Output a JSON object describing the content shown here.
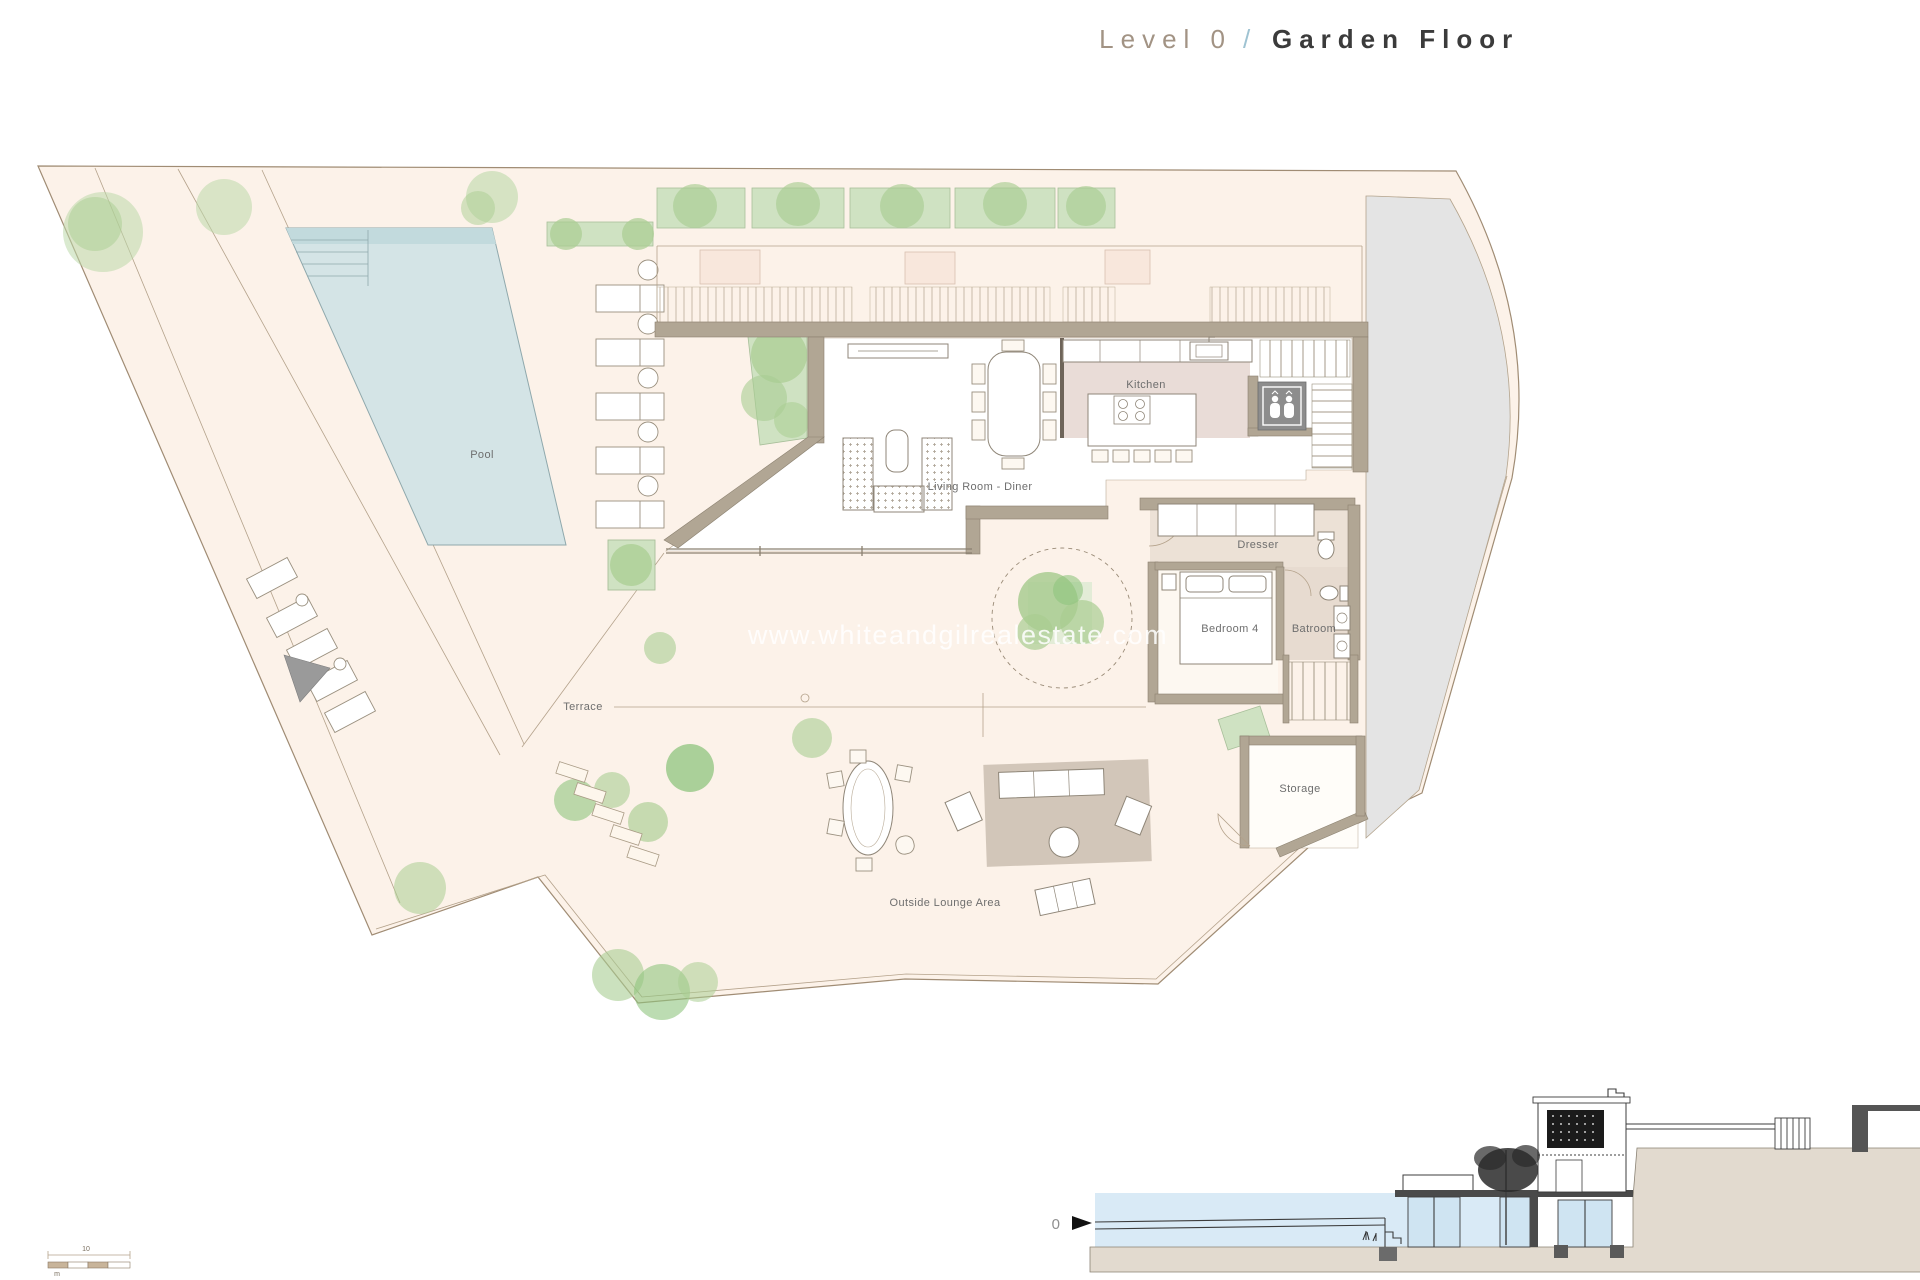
{
  "title": {
    "level": "Level 0",
    "separator": "/",
    "floor": "Garden Floor"
  },
  "watermark": "www.whiteandgilrealestate.com",
  "rooms": {
    "pool": "Pool",
    "terrace": "Terrace",
    "kitchen": "Kitchen",
    "living_room": "Living Room - Diner",
    "dresser": "Dresser",
    "bedroom4": "Bedroom 4",
    "bathroom": "Batroom",
    "storage": "Storage",
    "outside_lounge": "Outside Lounge Area"
  },
  "section": {
    "level_marker": "0"
  },
  "scale_bar": {
    "distance_label": "10",
    "unit_label": "m"
  },
  "colors": {
    "plot_fill": "#fcf2e9",
    "pool_water": "#d4e4e6",
    "wall": "#b1a694",
    "greenery": "#bcd8aa",
    "kitchen_floor": "#e9dcd7",
    "bath_floor": "#e7dbd0",
    "neighbor_area": "#e4e4e4",
    "section_sky": "#d9eaf6",
    "elevator_gray": "#8d8d8d",
    "title_dark": "#3b3b3b",
    "title_muted": "#a29384",
    "title_slash": "#9fc3d2"
  }
}
